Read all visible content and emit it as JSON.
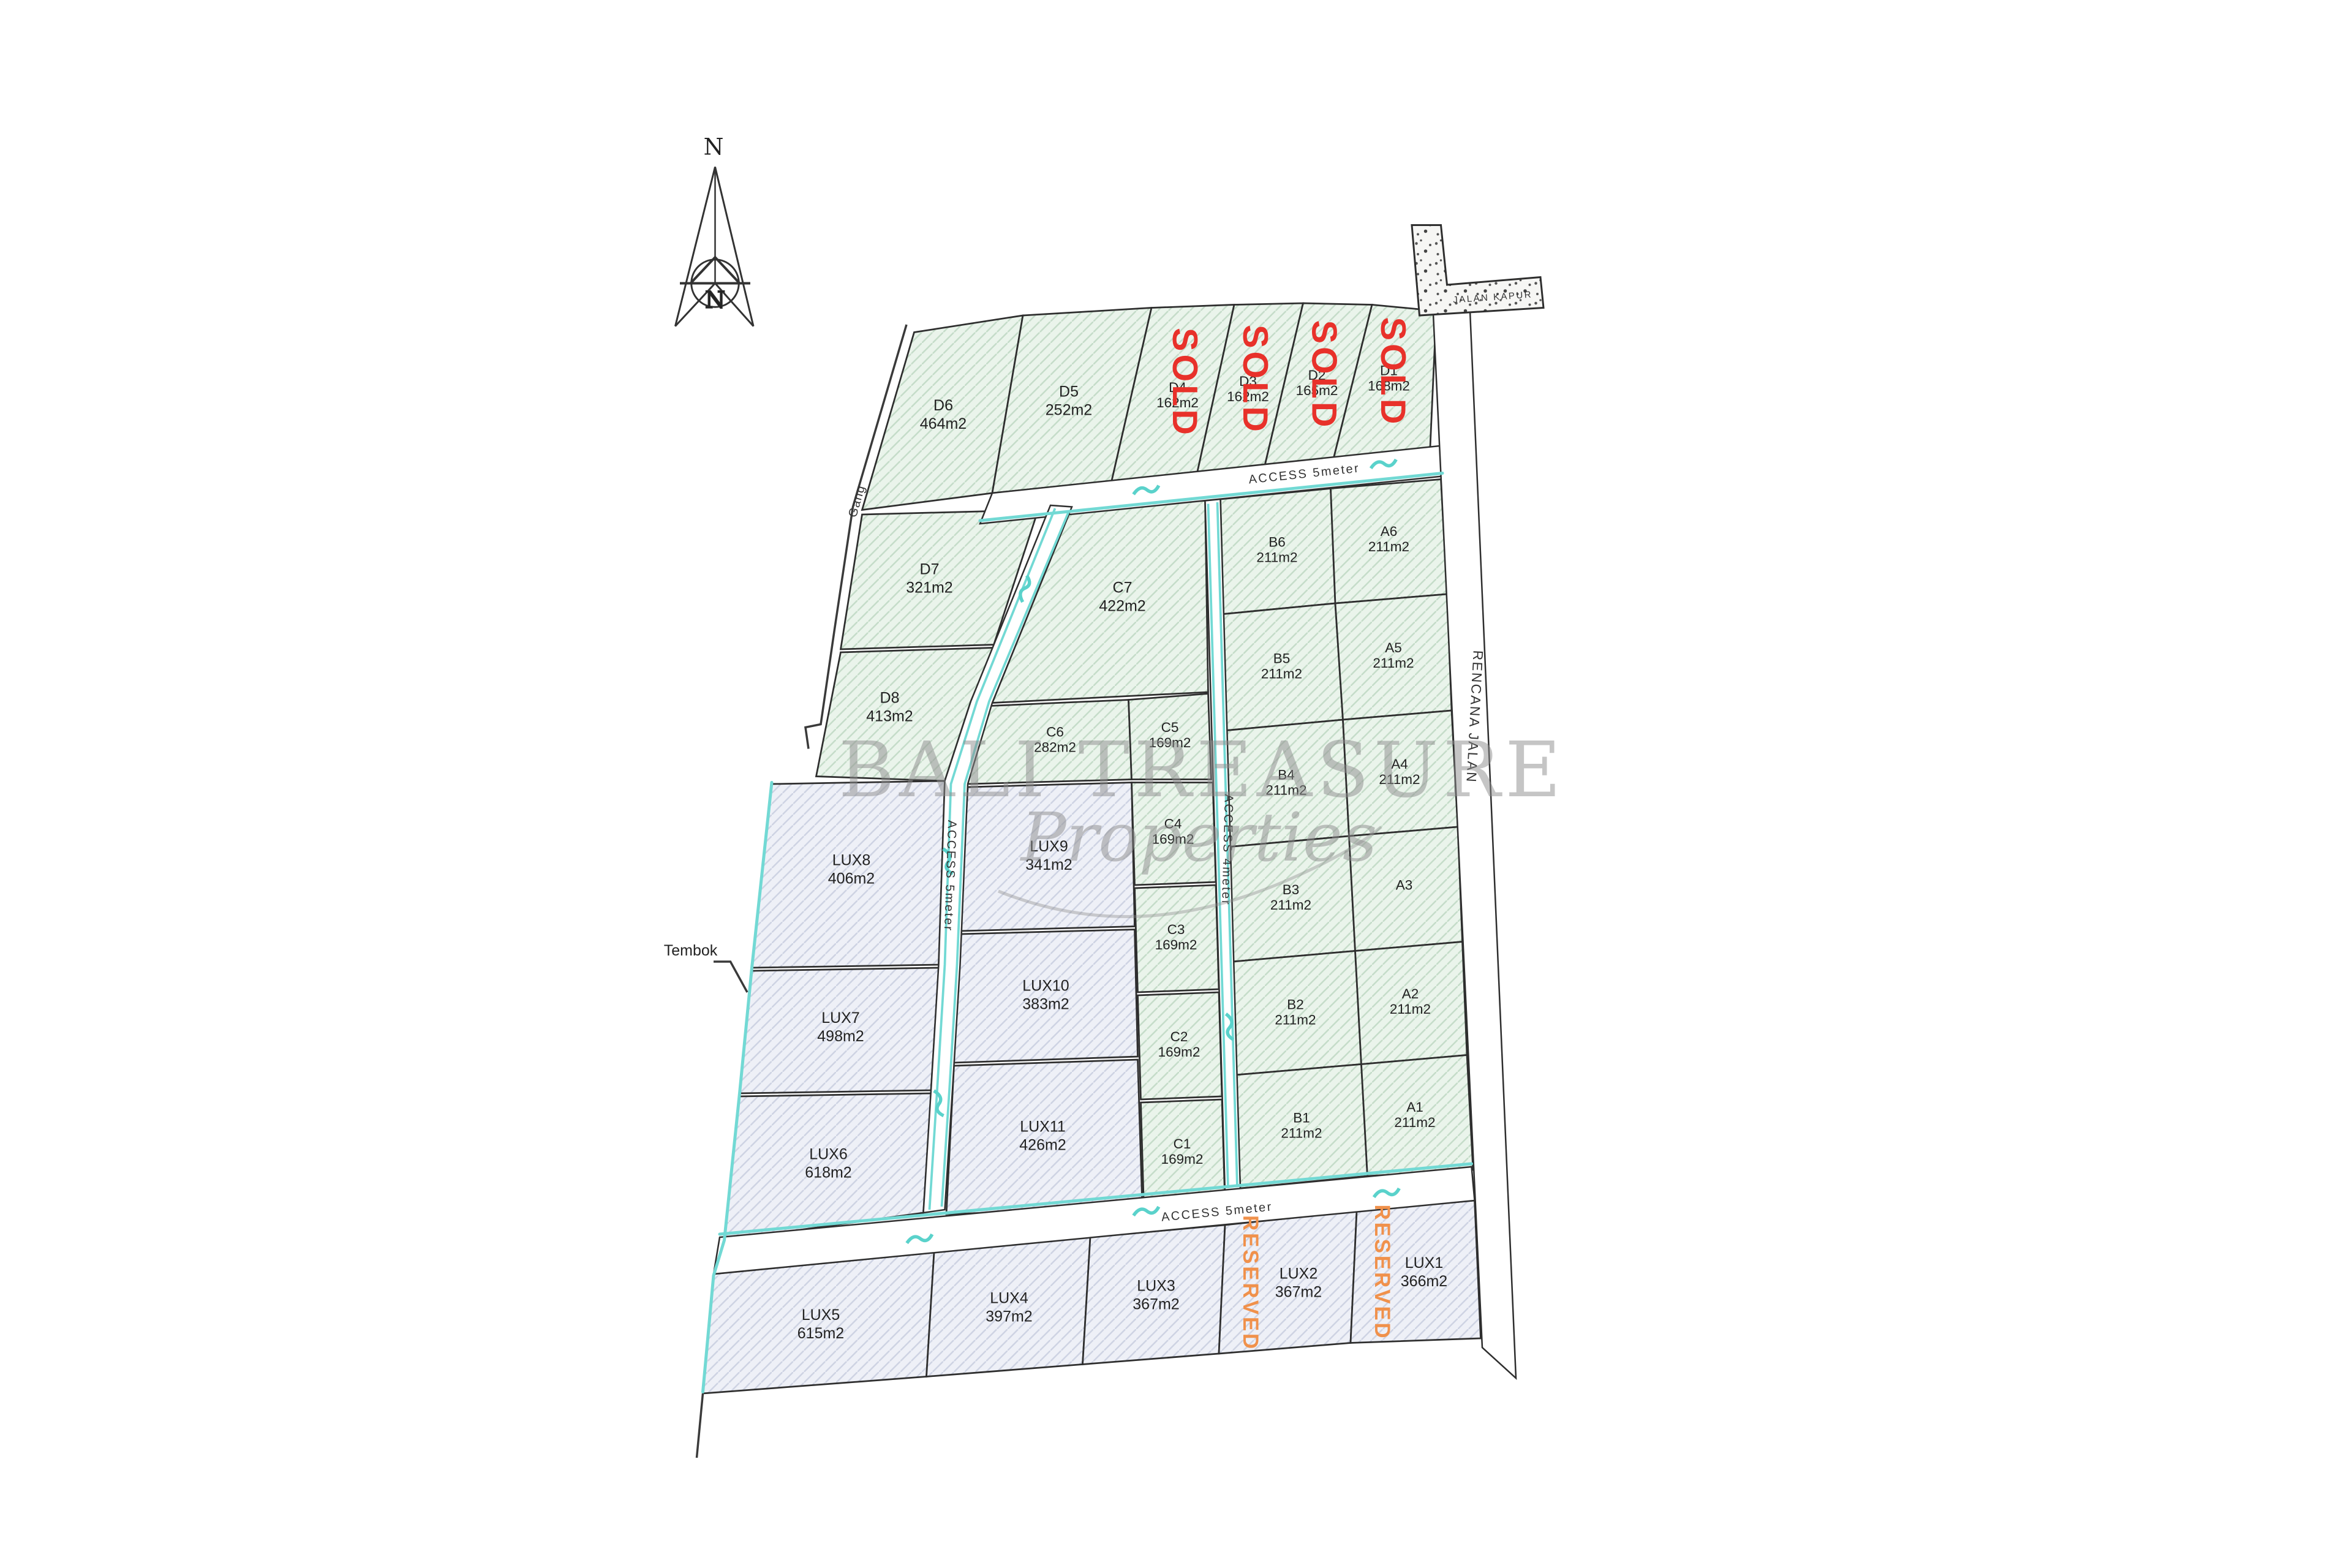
{
  "watermark": {
    "title": "BALI TREASURE",
    "subtitle": "Properties"
  },
  "compass": {
    "north": "N",
    "inner": "N"
  },
  "labels": {
    "jalan_kapur": "JALAN KAPUR",
    "rencana_jalan": "RENCANA JALAN",
    "access_top": "ACCESS 5meter",
    "access_left": "ACCESS 5meter",
    "access_mid": "ACCESS 4meter",
    "access_bottom": "ACCESS 5meter",
    "gang": "Gang",
    "tembok": "Tembok"
  },
  "statuses": {
    "sold": "SOLD",
    "reserved": "RESERVED"
  },
  "colors": {
    "sold": "#e8312a",
    "reserved": "#f0914b",
    "teal": "#72d9d4",
    "green_fill": "#eaf4eb",
    "lux_fill": "#eef0f7",
    "line": "#2e2e2e",
    "watermark": "#8c8c8c"
  },
  "plots": {
    "D6": {
      "id": "D6",
      "area": "464m2"
    },
    "D5": {
      "id": "D5",
      "area": "252m2"
    },
    "D4": {
      "id": "D4",
      "area": "162m2",
      "status": "SOLD"
    },
    "D3": {
      "id": "D3",
      "area": "162m2",
      "status": "SOLD"
    },
    "D2": {
      "id": "D2",
      "area": "165m2",
      "status": "SOLD"
    },
    "D1": {
      "id": "D1",
      "area": "168m2",
      "status": "SOLD"
    },
    "D7": {
      "id": "D7",
      "area": "321m2"
    },
    "D8": {
      "id": "D8",
      "area": "413m2"
    },
    "C7": {
      "id": "C7",
      "area": "422m2"
    },
    "C6": {
      "id": "C6",
      "area": "282m2"
    },
    "C5": {
      "id": "C5",
      "area": "169m2"
    },
    "C4": {
      "id": "C4",
      "area": "169m2"
    },
    "C3": {
      "id": "C3",
      "area": "169m2"
    },
    "C2": {
      "id": "C2",
      "area": "169m2"
    },
    "C1": {
      "id": "C1",
      "area": "169m2"
    },
    "B6": {
      "id": "B6",
      "area": "211m2"
    },
    "B5": {
      "id": "B5",
      "area": "211m2"
    },
    "B4": {
      "id": "B4",
      "area": "211m2"
    },
    "B3": {
      "id": "B3",
      "area": "211m2"
    },
    "B2": {
      "id": "B2",
      "area": "211m2"
    },
    "B1": {
      "id": "B1",
      "area": "211m2"
    },
    "A6": {
      "id": "A6",
      "area": "211m2"
    },
    "A5": {
      "id": "A5",
      "area": "211m2"
    },
    "A4": {
      "id": "A4",
      "area": "211m2"
    },
    "A3": {
      "id": "A3",
      "area": ""
    },
    "A2": {
      "id": "A2",
      "area": "211m2"
    },
    "A1": {
      "id": "A1",
      "area": "211m2"
    },
    "LUX8": {
      "id": "LUX8",
      "area": "406m2"
    },
    "LUX9": {
      "id": "LUX9",
      "area": "341m2"
    },
    "LUX10": {
      "id": "LUX10",
      "area": "383m2"
    },
    "LUX11": {
      "id": "LUX11",
      "area": "426m2"
    },
    "LUX7": {
      "id": "LUX7",
      "area": "498m2"
    },
    "LUX6": {
      "id": "LUX6",
      "area": "618m2"
    },
    "LUX5": {
      "id": "LUX5",
      "area": "615m2"
    },
    "LUX4": {
      "id": "LUX4",
      "area": "397m2"
    },
    "LUX3": {
      "id": "LUX3",
      "area": "367m2"
    },
    "LUX2": {
      "id": "LUX2",
      "area": "367m2",
      "status": "RESERVED"
    },
    "LUX1": {
      "id": "LUX1",
      "area": "366m2",
      "status": "RESERVED"
    }
  }
}
